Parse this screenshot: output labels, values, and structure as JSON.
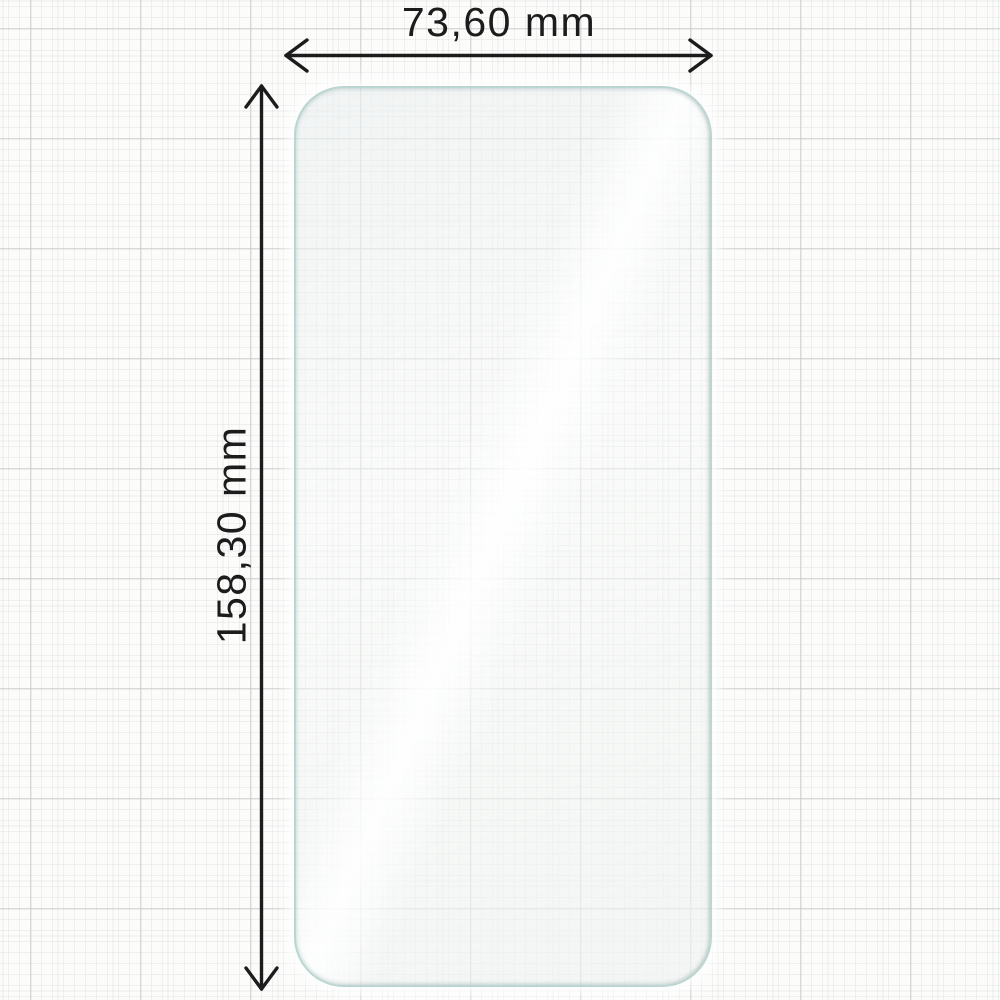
{
  "diagram": {
    "title": "screen protector dimension diagram",
    "width_label": "73,60 mm",
    "height_label": "158,30 mm",
    "width_value_mm": 73.6,
    "height_value_mm": 158.3,
    "unit": "mm"
  },
  "icons": {
    "width_arrow": "horizontal double-headed dimension arrow",
    "height_arrow": "vertical double-headed dimension arrow"
  },
  "colors": {
    "paper_background": "#fcfcfb",
    "grid_minor_line": "#eeefee",
    "grid_medium_line": "#e2e4e3",
    "grid_major_line": "#d5d7d6",
    "dimension_ink": "#1c1c1c",
    "protector_edge": "#b2d0ca",
    "protector_fill": "#f2f5f5",
    "reflection_highlight": "#ffffff"
  }
}
